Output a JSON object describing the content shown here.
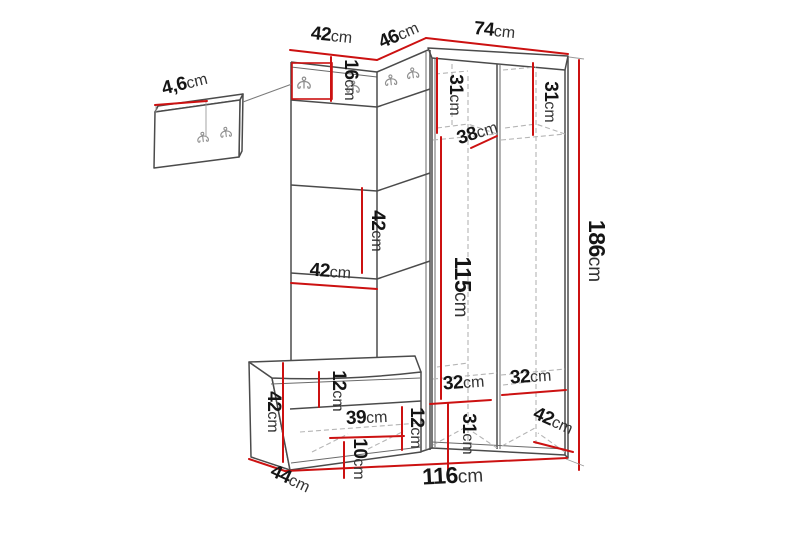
{
  "diagram": {
    "type": "furniture-dimension-diagram",
    "subject": "corner hallway unit with coat hooks, bench and separate wall hook panel",
    "unit": "cm",
    "colors": {
      "background": "#ffffff",
      "dimension_line": "#cc1111",
      "outline": "#4b4b4b",
      "hidden_line": "#b5b5b5",
      "hook": "#8f8f8f",
      "label_number": "#151515",
      "label_unit": "#333333"
    },
    "dimensions": {
      "wall_panel_thickness": {
        "value": "4,6",
        "unit": "cm"
      },
      "left_section_width": {
        "value": "42",
        "unit": "cm"
      },
      "corner_section_width": {
        "value": "46",
        "unit": "cm"
      },
      "right_section_width": {
        "value": "74",
        "unit": "cm"
      },
      "hook_panel_height": {
        "value": "16",
        "unit": "cm"
      },
      "right_left_column_top_height": {
        "value": "31",
        "unit": "cm"
      },
      "right_right_column_top_height": {
        "value": "31",
        "unit": "cm"
      },
      "shelf_depth": {
        "value": "38",
        "unit": "cm"
      },
      "left_shelf_section_height": {
        "value": "42",
        "unit": "cm"
      },
      "left_shelf_section_width": {
        "value": "42",
        "unit": "cm"
      },
      "interior_height": {
        "value": "115",
        "unit": "cm"
      },
      "total_height": {
        "value": "186",
        "unit": "cm"
      },
      "bench_height": {
        "value": "42",
        "unit": "cm"
      },
      "bench_top_section_height": {
        "value": "12",
        "unit": "cm"
      },
      "bench_shelf_width": {
        "value": "39",
        "unit": "cm"
      },
      "bench_mid_section_height": {
        "value": "12",
        "unit": "cm"
      },
      "bench_bottom_section_height": {
        "value": "10",
        "unit": "cm"
      },
      "left_column_interior_width": {
        "value": "32",
        "unit": "cm"
      },
      "right_column_interior_width": {
        "value": "32",
        "unit": "cm"
      },
      "left_column_bottom_height": {
        "value": "31",
        "unit": "cm"
      },
      "wardrobe_depth": {
        "value": "42",
        "unit": "cm"
      },
      "bench_depth": {
        "value": "44",
        "unit": "cm"
      },
      "total_width": {
        "value": "116",
        "unit": "cm"
      }
    }
  }
}
